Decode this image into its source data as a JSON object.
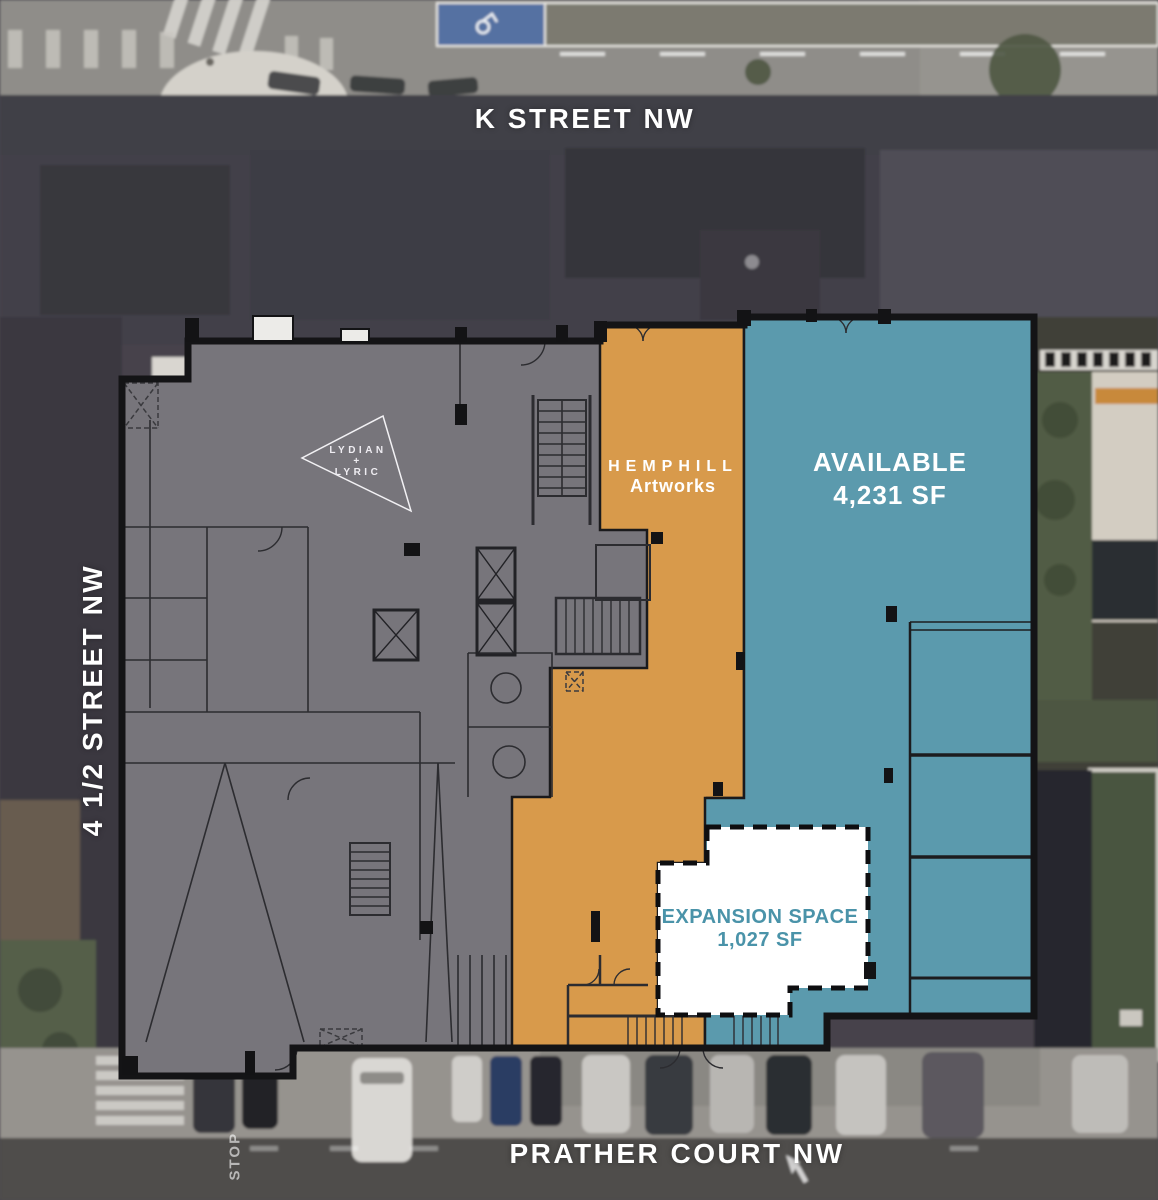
{
  "streets": {
    "top": "K STREET NW",
    "left": "4 1/2 STREET NW",
    "bottom": "PRATHER COURT NW"
  },
  "road_marking": "STOP",
  "suites": {
    "lydian_lyric": {
      "line1": "LYDIAN",
      "line2": "+",
      "line3": "LYRIC",
      "fill": "#77757b"
    },
    "hemphill": {
      "name": "HEMPHILL",
      "dept": "Artworks",
      "fill": "#d89a4b"
    },
    "available": {
      "label": "AVAILABLE",
      "area": "4,231 SF",
      "fill": "#5b9aad"
    },
    "expansion": {
      "label": "EXPANSION SPACE",
      "area": "1,027 SF",
      "fill": "#ffffff",
      "text_color": "#4a93a9"
    }
  }
}
